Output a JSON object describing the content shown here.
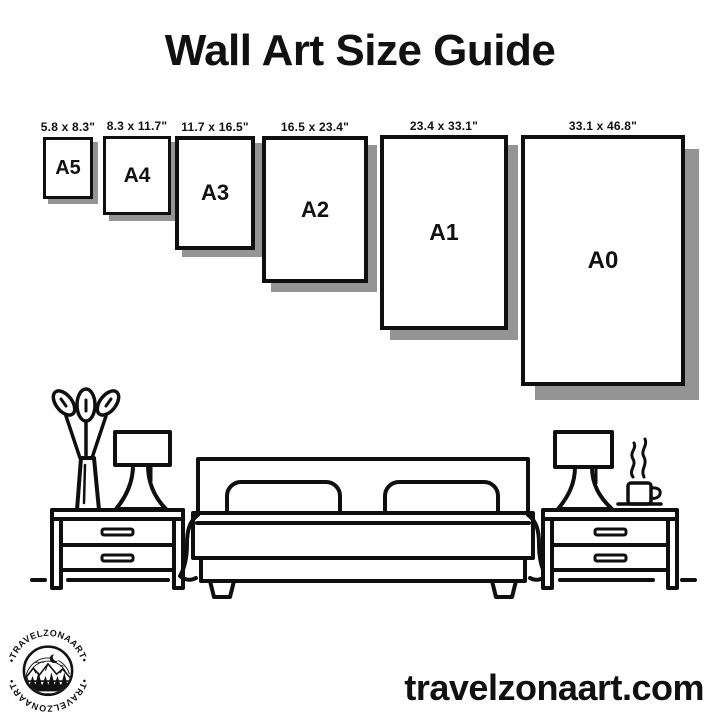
{
  "title": "Wall Art Size Guide",
  "sizes": [
    {
      "label": "A5",
      "dimensions": "5.8 x 8.3\""
    },
    {
      "label": "A4",
      "dimensions": "8.3 x 11.7\""
    },
    {
      "label": "A3",
      "dimensions": "11.7 x 16.5\""
    },
    {
      "label": "A2",
      "dimensions": "16.5 x 23.4\""
    },
    {
      "label": "A1",
      "dimensions": "23.4 x 33.1\""
    },
    {
      "label": "A0",
      "dimensions": "33.1 x 46.8\""
    }
  ],
  "logo": {
    "arc_text": "•TRAVELZONAART•"
  },
  "footer": {
    "website": "travelzonaart.com"
  },
  "colors": {
    "ink": "#0f0f0f",
    "shadow": "#949494",
    "background": "#ffffff"
  },
  "illustration": {
    "icons": [
      "plant-vase-icon",
      "table-lamp-icon",
      "nightstand-icon",
      "double-bed-icon",
      "pillow-icon",
      "coffee-mug-steam-icon",
      "mountain-badge-icon"
    ]
  }
}
